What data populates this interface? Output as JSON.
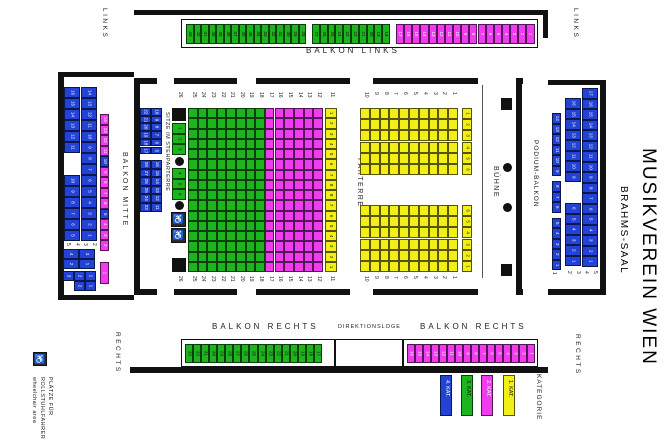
{
  "title": "MUSIKVEREIN WIEN",
  "subtitle": "BRAHMS-SAAL",
  "colors": {
    "kat1": "#f2ef16",
    "kat2": "#ee3cee",
    "kat3": "#1eb41e",
    "kat4": "#2342d6",
    "wall": "#111111"
  },
  "orientation": {
    "top_left": "LINKS",
    "top_right": "LINKS",
    "bottom_left": "RECHTS",
    "bottom_right": "RECHTS"
  },
  "legend": {
    "heading": "KATEGORIE",
    "items": [
      {
        "label": "4. KAT.",
        "color_key": "kat4"
      },
      {
        "label": "3. KAT.",
        "color_key": "kat3"
      },
      {
        "label": "2. KAT.",
        "color_key": "kat2"
      },
      {
        "label": "1. KAT.",
        "color_key": "kat1"
      }
    ]
  },
  "wheelchair_note": {
    "lines": [
      "PLÄTZE FÜR",
      "ROLLSTUHLFAHRER",
      "wheelchair area"
    ]
  },
  "balkon_links": {
    "label": "BALKON LINKS",
    "group_a": [
      43,
      42,
      41,
      40,
      39,
      38,
      37,
      36,
      35,
      34,
      33,
      32,
      31,
      30,
      29,
      28
    ],
    "group_b": [
      27,
      26,
      25,
      24,
      23,
      22,
      21,
      20,
      19,
      18
    ],
    "group_c": [
      17,
      16,
      15,
      14,
      13,
      12,
      11,
      10,
      9,
      8,
      7,
      6,
      5,
      4,
      3,
      2,
      1
    ]
  },
  "balkon_rechts_left": {
    "label": "BALKON RECHTS",
    "seats": [
      33,
      32,
      31,
      30,
      29,
      28,
      27,
      26,
      25,
      24,
      23,
      22,
      21,
      20,
      19,
      18,
      17
    ]
  },
  "direktionsloge": {
    "label": "DIREKTIONSLOGE"
  },
  "balkon_rechts_right": {
    "label": "BALKON RECHTS",
    "seats": [
      16,
      15,
      14,
      13,
      12,
      11,
      10,
      9,
      8,
      7,
      6,
      5,
      4,
      3,
      2,
      1
    ]
  },
  "balkon_mitte": {
    "label": "BALKON MITTE",
    "outer_upper": [
      16,
      15,
      14,
      13,
      12,
      11
    ],
    "inner_upper": [
      14,
      13,
      12,
      11,
      10,
      9
    ],
    "notch_inner": [
      8,
      7
    ],
    "outer_lower": [
      10,
      9,
      8,
      7,
      6,
      5
    ],
    "inner_lower": [
      6,
      5,
      4,
      3,
      2,
      1
    ],
    "floating_labels": [
      "5",
      "4",
      "3",
      "2"
    ],
    "block_a": [
      [
        "4",
        "3"
      ],
      [
        "2",
        "1"
      ]
    ],
    "block_b": [
      [
        "3",
        "2",
        "1"
      ],
      [
        "2",
        "1"
      ]
    ],
    "strip": [
      14,
      13,
      12,
      11,
      10,
      9,
      8,
      7,
      6,
      5,
      4,
      3,
      2
    ],
    "strip_blue_numbers": [
      10,
      5
    ],
    "strip_tail": "1"
  },
  "podium_balkon": {
    "label": "PODIUM-BALKON",
    "outer_col": [
      17,
      16,
      15,
      14,
      13,
      12,
      11,
      10,
      9,
      8,
      7,
      6,
      5,
      4,
      3,
      2,
      1
    ],
    "inner_upper": [
      16,
      15,
      14,
      13,
      12,
      11,
      10,
      9
    ],
    "inner_lower": [
      6,
      5,
      4,
      3,
      2,
      1
    ],
    "strip_groups": [
      [
        14,
        13,
        12,
        11,
        10,
        9
      ],
      [
        8,
        7,
        6
      ],
      [
        5,
        4,
        3,
        2,
        1
      ]
    ],
    "floating_labels": [
      "2",
      "3",
      "4",
      "5"
    ],
    "strip_tail": "1"
  },
  "stehparterre": {
    "label": "SITZE IM STEHPARTERRE",
    "top_block": {
      "outer": [
        22,
        21,
        20,
        19,
        18,
        17
      ],
      "inner": [
        10,
        9,
        8,
        7,
        6,
        5
      ]
    },
    "bottom_block": {
      "outer": [
        28,
        27,
        26,
        25,
        24,
        23
      ],
      "inner": [
        16,
        15,
        14,
        13,
        12,
        11
      ]
    }
  },
  "parterre": {
    "label": "PARTERRE",
    "row_labels": [
      26,
      25,
      24,
      23,
      22,
      21,
      20,
      19,
      18,
      17,
      16,
      15,
      14,
      13,
      12,
      11,
      10,
      9,
      8,
      7,
      6,
      5,
      4,
      3,
      2,
      1
    ],
    "green_rows": [
      25,
      24,
      23,
      22,
      21,
      20,
      19,
      18
    ],
    "magenta_rows": [
      17,
      16,
      15,
      14,
      13,
      12
    ],
    "yellow_rows": [
      10,
      9,
      8,
      7,
      6,
      5,
      4,
      3,
      2,
      1
    ],
    "row11_numbers": [
      1,
      2,
      3,
      4,
      5,
      6,
      7,
      8,
      8,
      7,
      6,
      5,
      4,
      3,
      2,
      1
    ],
    "guide_upper": [
      1,
      2,
      3,
      4,
      5,
      6
    ],
    "guide_lower": [
      6,
      5,
      4,
      3,
      2,
      1
    ],
    "col26_top": [
      1,
      2,
      3
    ],
    "col26_bottom": [
      4,
      5,
      6
    ]
  },
  "buehne": {
    "label": "BÜHNE"
  }
}
